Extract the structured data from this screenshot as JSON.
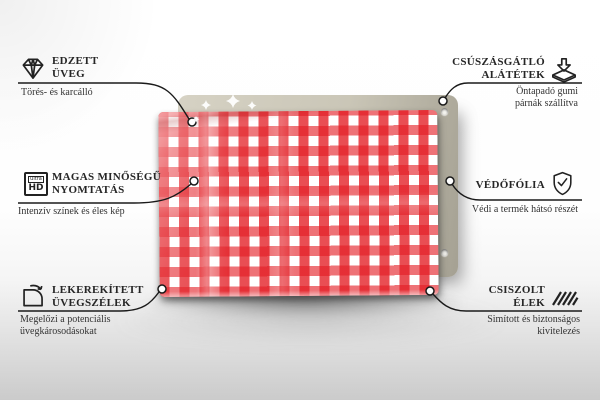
{
  "board": {
    "pattern": "red-white-gingham-check",
    "mounting_holes": 2
  },
  "colors": {
    "gingham_red": "#e31c23",
    "back_panel_beige": "#cac6b7",
    "connector_line": "#1a1a1a",
    "floor_gray": "#cbcbcb"
  },
  "callouts": {
    "left": [
      {
        "icon": "diamond-icon",
        "title_lines": [
          "EDZETT",
          "ÜVEG"
        ],
        "subtitle_lines": [
          "Törés- és karcálló"
        ]
      },
      {
        "icon": "ultra-hd-icon",
        "icon_text": {
          "top": "ultra",
          "bottom": "HD"
        },
        "title_lines": [
          "MAGAS MINŐSÉGŰ",
          "NYOMTATÁS"
        ],
        "subtitle_lines": [
          "Intenzív színek és éles kép"
        ]
      },
      {
        "icon": "rounded-corner-icon",
        "title_lines": [
          "LEKEREKÍTETT",
          "ÜVEGSZÉLEK"
        ],
        "subtitle_lines": [
          "Megelőzi a potenciális",
          "üvegkárosodásokat"
        ]
      }
    ],
    "right": [
      {
        "icon": "anti-slip-pads-icon",
        "title_lines": [
          "CSÚSZÁSGÁTLÓ",
          "ALÁTÉTEK"
        ],
        "subtitle_lines": [
          "Öntapadó gumi",
          "párnák szállítva"
        ]
      },
      {
        "icon": "shield-check-icon",
        "title_lines": [
          "VÉDŐFÓLIA"
        ],
        "subtitle_lines": [
          "Védi a termék hátsó részét"
        ]
      },
      {
        "icon": "polished-edges-icon",
        "title_lines": [
          "CSISZOLT",
          "ÉLEK"
        ],
        "subtitle_lines": [
          "Simított és biztonságos",
          "kivitelezés"
        ]
      }
    ]
  }
}
